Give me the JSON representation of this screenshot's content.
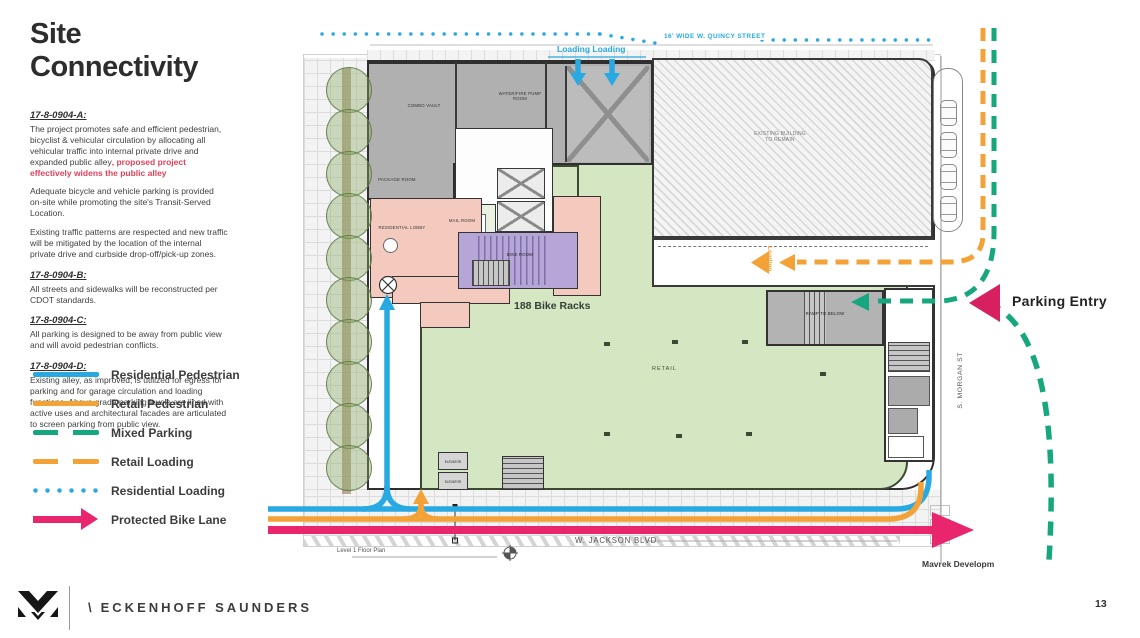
{
  "slide": {
    "title": "Site Connectivity"
  },
  "sections": [
    {
      "heading": "17-8-0904-A:",
      "para1": "The project promotes safe and efficient pedestrian, bicyclist & vehicular circulation by allocating all vehicular traffic into internal private drive and expanded public alley",
      "red_note": ", proposed project effectively widens the public alley",
      "para2": "Adequate bicycle and vehicle parking is provided on-site while promoting the site's Transit-Served Location.",
      "para3": "Existing traffic patterns are respected and new traffic will be mitigated by the location of the internal private drive and curbside drop-off/pick-up zones."
    },
    {
      "heading": "17-8-0904-B:",
      "para1": "All streets and sidewalks will be reconstructed per CDOT standards."
    },
    {
      "heading": "17-8-0904-C:",
      "para1": "All parking is designed to be away from public view and will avoid pedestrian conflicts."
    },
    {
      "heading": "17-8-0904-D:",
      "para1": "Existing alley, as improved, is utilized for egress for parking and for garage circulation and loading functions. Above grade parking levels are lined with active uses and architectural facades are articulated to screen parking from public view."
    }
  ],
  "legend": {
    "items": [
      {
        "label": "Residential Pedestrian",
        "style": "solid",
        "color": "#29a9e1"
      },
      {
        "label": "Retail Pedestrian",
        "style": "solid",
        "color": "#f3a237"
      },
      {
        "label": "Mixed Parking",
        "style": "dashed",
        "color": "#17a77e"
      },
      {
        "label": "Retail Loading",
        "style": "dashed",
        "color": "#f3a237"
      },
      {
        "label": "Residential Loading",
        "style": "dotted",
        "color": "#29a9e1"
      },
      {
        "label": "Protected Bike Lane",
        "style": "arrow",
        "color": "#e8256d"
      }
    ]
  },
  "plan": {
    "quincy_street": "16' WIDE W. QUINCY STREET",
    "jackson_blvd": "W. JACKSON BLVD.",
    "morgan_st": "S. MORGAN ST",
    "loading_top": "Loading Loading",
    "loading_side": "Loading",
    "parking_entry": "Parking Entry",
    "bike_racks": "188 Bike Racks",
    "level_label": "Level 1 Floor Plan",
    "credit": "Mavrek Developm",
    "rooms": {
      "combo_vault": "COMBO VAULT",
      "pump_room": "WATER/FIRE PUMP ROOM",
      "package_room": "PACKAGE ROOM",
      "residential_lobby": "RESIDENTIAL LOBBY",
      "mail_room": "MAIL ROOM",
      "bike_room": "BIKE ROOM",
      "retail": "RETAIL",
      "existing_building": "EXISTING BUILDING TO REMAIN",
      "ramp": "RAMP TO BELOW",
      "elevator": "ELEVATOR"
    }
  },
  "footer": {
    "brand_prefix": "\\",
    "brand": "ECKENHOFF SAUNDERS",
    "page_number": "13"
  },
  "colors": {
    "residential_blue": "#29a9e1",
    "retail_orange": "#f3a237",
    "mixed_green": "#17a77e",
    "bike_pink": "#e8256d",
    "parking_entry_marker": "#d6205f",
    "red_note": "#e0415a",
    "retail_fill": "#d5e6c3",
    "lobby_pink_fill": "#f3cabd",
    "bike_room_purple_fill": "#b6a6d8"
  }
}
